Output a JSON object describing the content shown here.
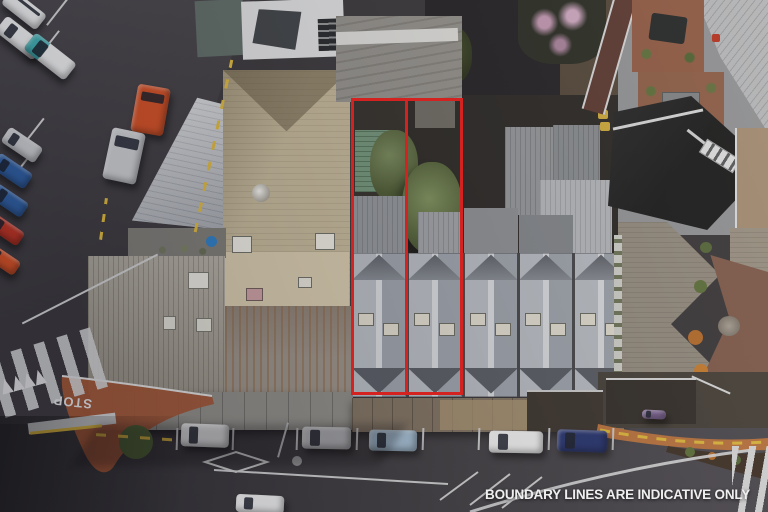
{
  "overlay": {
    "disclaimer": "BOUNDARY LINES ARE INDICATIVE ONLY"
  },
  "road_markings": {
    "stop": "STOP"
  },
  "boundary": {
    "color": "#d42220",
    "plots": 2,
    "style": "solid-outline"
  },
  "colors": {
    "asphalt": "#3a383c",
    "asphalt_light": "#4a484d",
    "marking_white": "#d2d3d5",
    "marking_yellow": "#d7b33e",
    "tan_roof": "#bdb195",
    "weathered": "#a29d92",
    "awning_gray": "#8a8984",
    "awning_brown": "#7d7060",
    "shed_green": "#6f9077",
    "taupe": "#8f887d",
    "terracotta": "#9c5436",
    "curb_orange": "#b5713f",
    "soil": "#3f3228",
    "car_white": "#e8e9ea",
    "car_silver": "#c7c9cc",
    "car_teal": "#3fa9ad",
    "car_orange": "#cc4f26",
    "car_blue": "#2f5d9e",
    "car_lightblue": "#9fb8cc",
    "car_darkblue": "#28356e",
    "car_red": "#b63324",
    "car_purple": "#7a6292"
  }
}
